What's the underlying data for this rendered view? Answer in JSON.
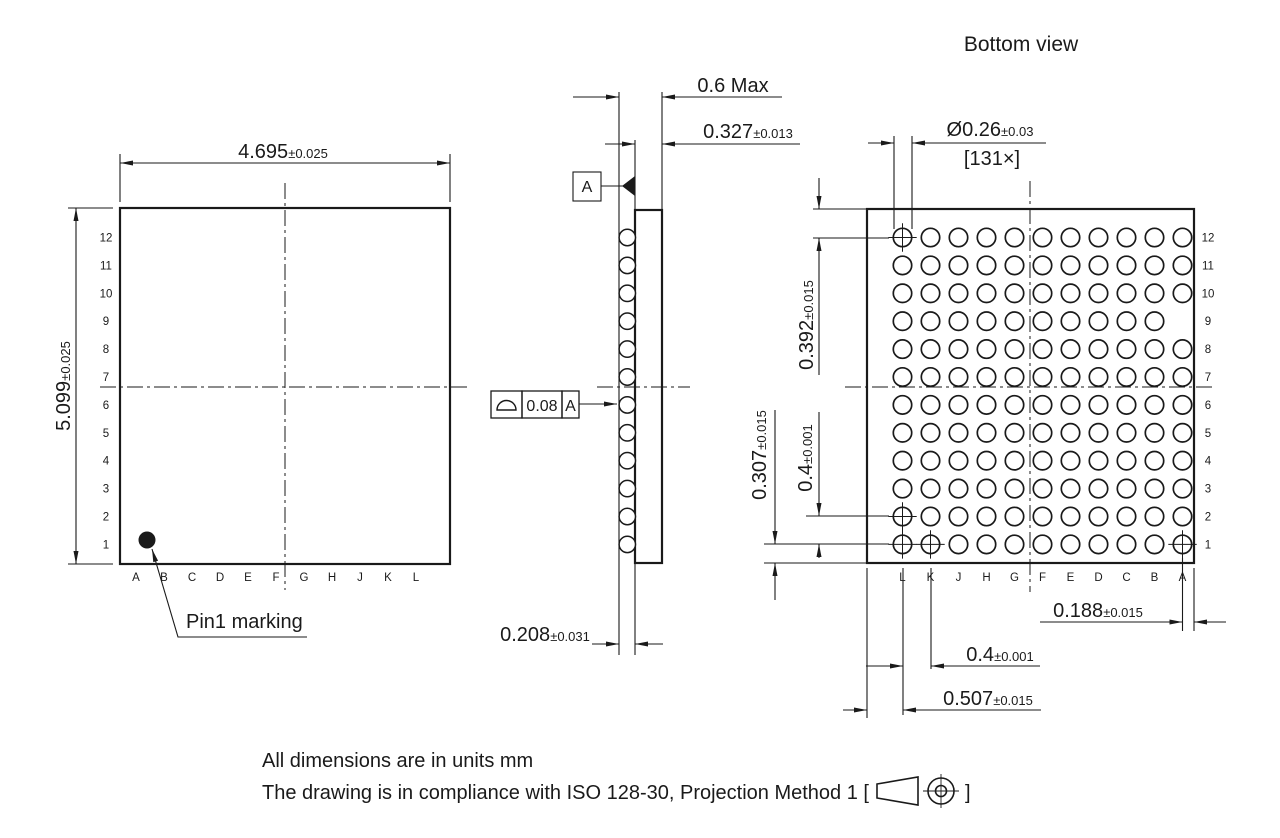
{
  "bottom_view_title": "Bottom view",
  "top_view": {
    "width_dim": {
      "value": "4.695",
      "tol": "±0.025"
    },
    "height_dim": {
      "value": "5.099",
      "tol": "±0.025"
    },
    "pin1_label": "Pin1 marking",
    "rows": [
      "12",
      "11",
      "10",
      "9",
      "8",
      "7",
      "6",
      "5",
      "4",
      "3",
      "2",
      "1"
    ],
    "cols": [
      "A",
      "B",
      "C",
      "D",
      "E",
      "F",
      "G",
      "H",
      "J",
      "K",
      "L"
    ]
  },
  "side_view": {
    "overall_dim": {
      "value": "0.6 Max",
      "tol": ""
    },
    "body_dim": {
      "value": "0.327",
      "tol": "±0.013"
    },
    "ball_dim": {
      "value": "0.208",
      "tol": "±0.031"
    },
    "datum_label": "A",
    "flatness": {
      "symbol": "profile-of-a-surface",
      "tolerance": "0.08",
      "datum": "A"
    }
  },
  "bottom_view": {
    "ball_dia_dim": {
      "value": "Ø0.26",
      "tol": "±0.03"
    },
    "ball_count": "[131×]",
    "edge_top_dim": {
      "value": "0.392",
      "tol": "±0.015"
    },
    "pitch_v_dim": {
      "value": "0.4",
      "tol": "±0.001"
    },
    "edge_bottom_dim": {
      "value": "0.307",
      "tol": "±0.015"
    },
    "edge_right_dim": {
      "value": "0.188",
      "tol": "±0.015"
    },
    "pitch_h_dim": {
      "value": "0.4",
      "tol": "±0.001"
    },
    "edge_left_dim": {
      "value": "0.507",
      "tol": "±0.015"
    },
    "rows": [
      "12",
      "11",
      "10",
      "9",
      "8",
      "7",
      "6",
      "5",
      "4",
      "3",
      "2",
      "1"
    ],
    "cols": [
      "L",
      "K",
      "J",
      "H",
      "G",
      "F",
      "E",
      "D",
      "C",
      "B",
      "A"
    ],
    "missing_balls": [
      "A9"
    ],
    "marked_balls": [
      "L12",
      "L2",
      "L1",
      "K1",
      "A1"
    ]
  },
  "notes": {
    "line1": "All dimensions are in units mm",
    "line2_prefix": "The drawing is in compliance with ISO 128-30, Projection Method 1 [",
    "line2_suffix": "]"
  }
}
